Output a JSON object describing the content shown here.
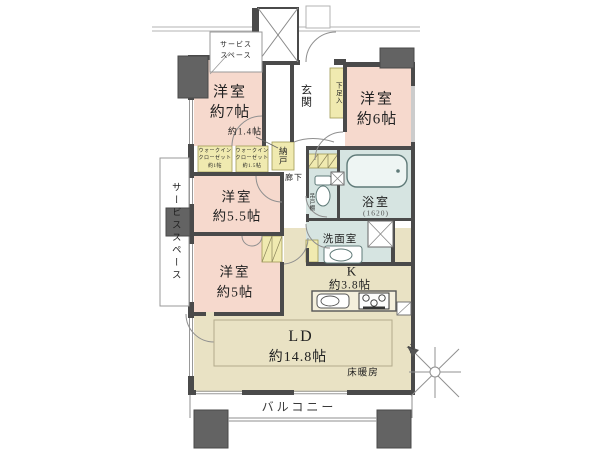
{
  "plan": {
    "bedrooms": {
      "b7": {
        "name": "洋室",
        "area": "約7帖"
      },
      "b6": {
        "name": "洋室",
        "area": "約6帖"
      },
      "b55": {
        "name": "洋室",
        "area": "約5.5帖"
      },
      "b5": {
        "name": "洋室",
        "area": "約5帖"
      }
    },
    "living_dining": {
      "name": "LD",
      "area": "約14.8帖",
      "floor_heating": "床暖房"
    },
    "kitchen": {
      "name": "K",
      "area": "約3.8帖"
    },
    "bathroom": {
      "name": "浴室",
      "size": "(1620)"
    },
    "washroom": {
      "name": "洗面室"
    },
    "toilet_shelf": {
      "name": "吊戸棚"
    },
    "entrance": {
      "name": "玄関",
      "shoe_cabinet": "下足入"
    },
    "hallway": {
      "name": "廊下"
    },
    "storage_room": {
      "name": "納戸"
    },
    "walk_in_closets": {
      "left": {
        "l1": "ウォークイン",
        "l2": "クローゼット",
        "l3": "約1帖"
      },
      "right": {
        "l1": "ウォークイン",
        "l2": "クローゼット",
        "l3": "約1.5帖"
      },
      "annotation": "約1.4帖"
    },
    "balcony": {
      "name": "バルコニー"
    },
    "service_space_left": {
      "name": "サービススペース"
    },
    "service_space_top": {
      "l1": "サービス",
      "l2": "スペース"
    },
    "compass": {
      "north": "N"
    }
  },
  "colors": {
    "room_pink": "#f6d9cd",
    "living_beige": "#e9e2c4",
    "wet_area_blue": "#d6e4e1",
    "storage_yellow": "#f0eab0",
    "wall_gray": "#4a4a4a",
    "pillar_gray": "#636363"
  }
}
